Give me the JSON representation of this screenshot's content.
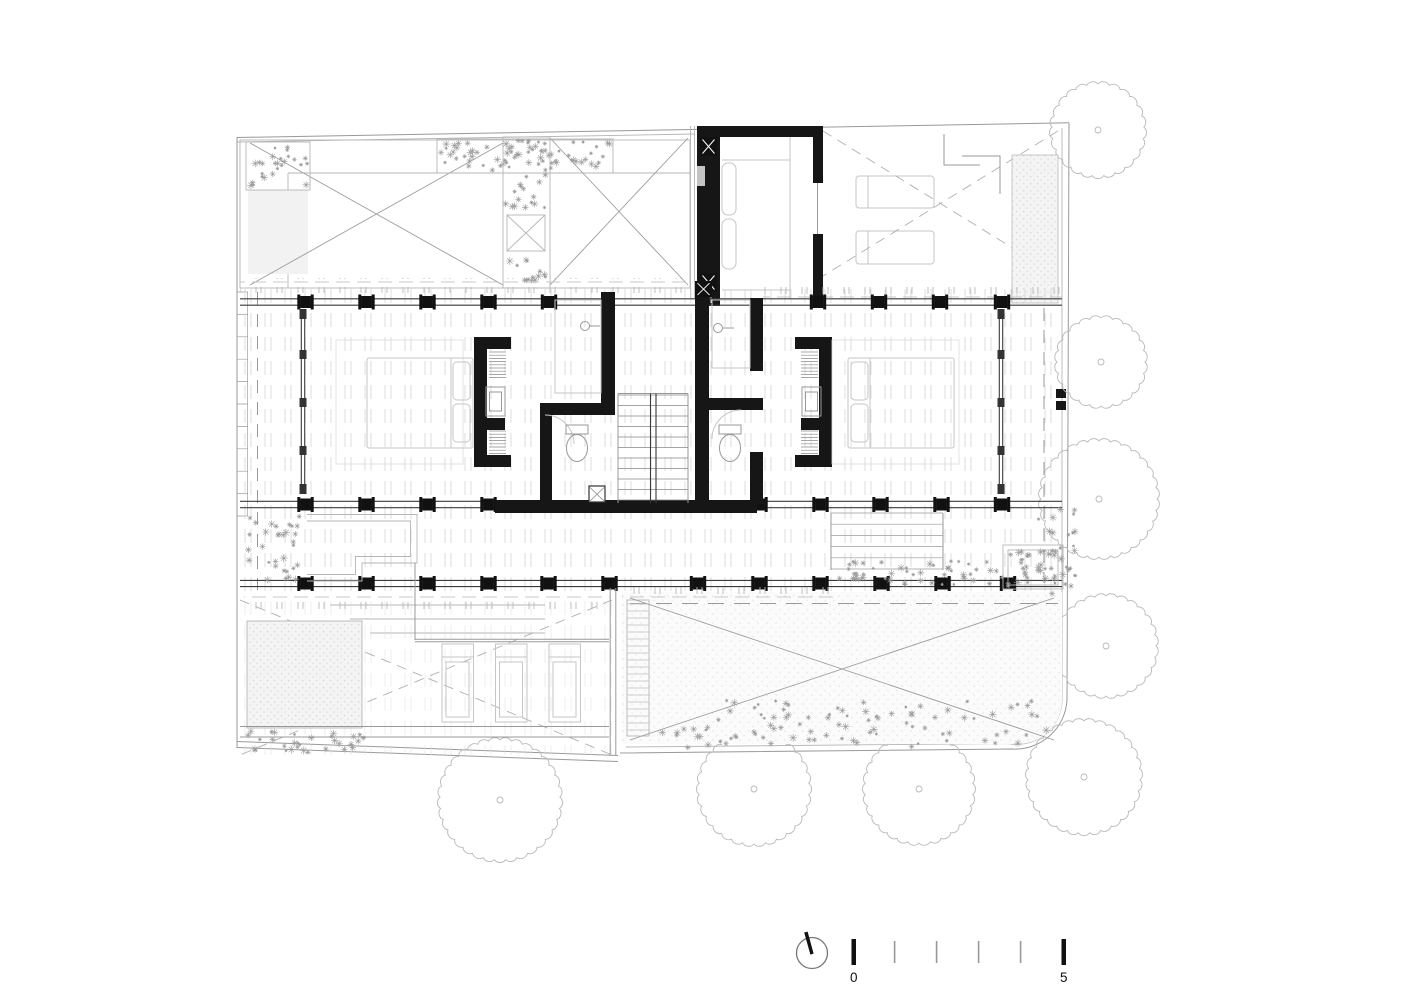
{
  "drawing": {
    "kind": "floor-plan",
    "visible_text": [
      "0",
      "5"
    ]
  },
  "scale_bar": {
    "start_label": "0",
    "end_label": "5",
    "tick_count": 6
  },
  "compass": {
    "icon": "north-arrow-icon"
  },
  "palette": {
    "paper": "#ffffff",
    "wall_ink": "#161616",
    "structure_line": "#3a3a3a",
    "site_line": "#999999",
    "furniture_line": "#c6c6c6",
    "deck_joint": "#dcdcdc",
    "vegetation": "#9a9a9a",
    "tree_outline": "#b9b9b9"
  }
}
